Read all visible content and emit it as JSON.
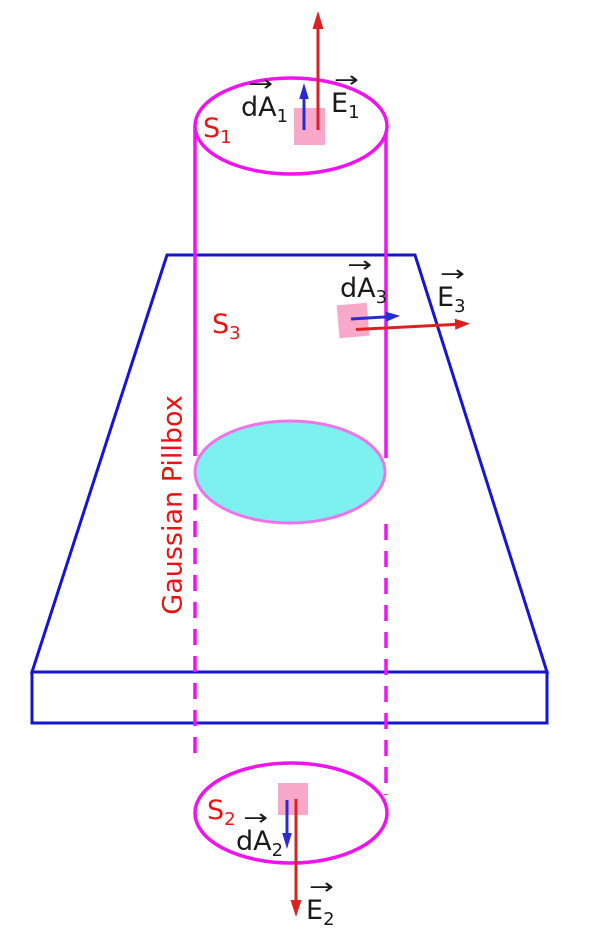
{
  "figure": {
    "kind": "physics-diagram",
    "subject": "Gaussian pillbox (cylindrical Gaussian surface) passing through a charged slab"
  },
  "colors": {
    "background": "#ffffff",
    "magenta": "#f112f0",
    "slab_blue": "#1515d2",
    "arrow_blue": "#2b2bd5",
    "arrow_red": "#dd2020",
    "label_red": "#ee1111",
    "label_black": "#1a1a1a",
    "cyan_fill": "#7df0f0",
    "cyan_stroke": "#ef74ea",
    "patch_pink": "#f8a9c9"
  },
  "glyphs": {
    "vec_arrow": "→"
  },
  "labels": {
    "gaussian_pillbox": "Gaussian Pillbox",
    "s1": {
      "base": "S",
      "sub": "1"
    },
    "s2": {
      "base": "S",
      "sub": "2"
    },
    "s3": {
      "base": "S",
      "sub": "3"
    },
    "da1": {
      "base": "dA",
      "sub": "1"
    },
    "da2": {
      "base": "dA",
      "sub": "2"
    },
    "da3": {
      "base": "dA",
      "sub": "3"
    },
    "e1": {
      "base": "E",
      "sub": "1"
    },
    "e2": {
      "base": "E",
      "sub": "2"
    },
    "e3": {
      "base": "E",
      "sub": "3"
    }
  }
}
